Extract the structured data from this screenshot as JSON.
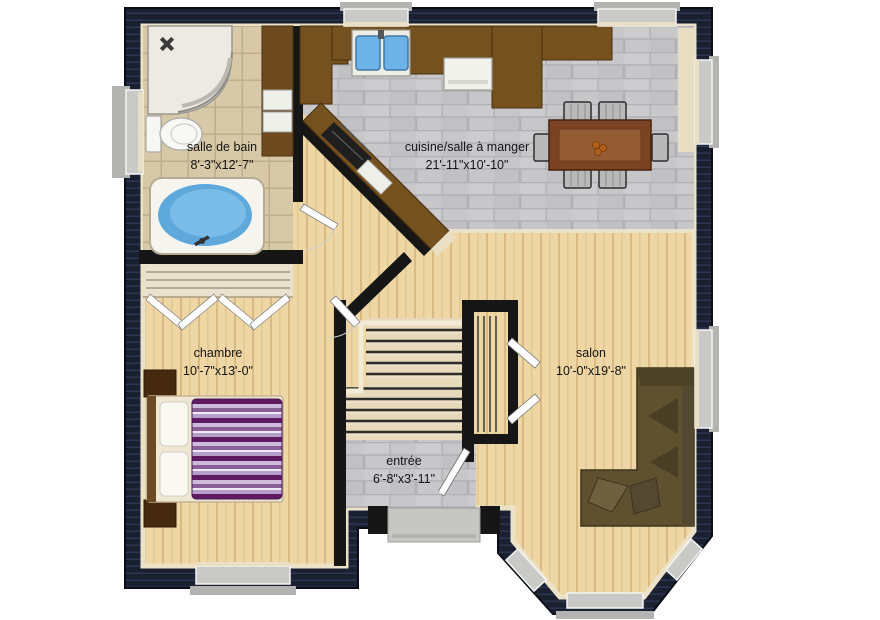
{
  "plan": {
    "title": "floor-plan",
    "rooms": [
      {
        "id": "bathroom",
        "label": "salle de bain",
        "dims": "8'-3\"x12'-7\""
      },
      {
        "id": "kitchen_dining",
        "label": "cuisine/salle à manger",
        "dims": "21'-11\"x10'-10\""
      },
      {
        "id": "bedroom",
        "label": "chambre",
        "dims": "10'-7\"x13'-0\""
      },
      {
        "id": "living_room",
        "label": "salon",
        "dims": "10'-0\"x19'-8\""
      },
      {
        "id": "entry",
        "label": "entrée",
        "dims": "6'-8\"x3'-11\""
      }
    ],
    "colors": {
      "exterior_wall": "#1a2030",
      "interior_wall": "#161616",
      "wood_floor": "#eed7a4",
      "beige_tile": "#d7c9a7",
      "gray_tile": "#c7c7ca",
      "cabinet_brown": "#74511f",
      "table_brown": "#7c4322",
      "sofa_brown": "#5f5130",
      "bed_purple": "#5e1b64",
      "tub_water": "#5fa8dc",
      "sink_blue": "#6db3e8",
      "window_gray": "#c9c9c7"
    }
  }
}
